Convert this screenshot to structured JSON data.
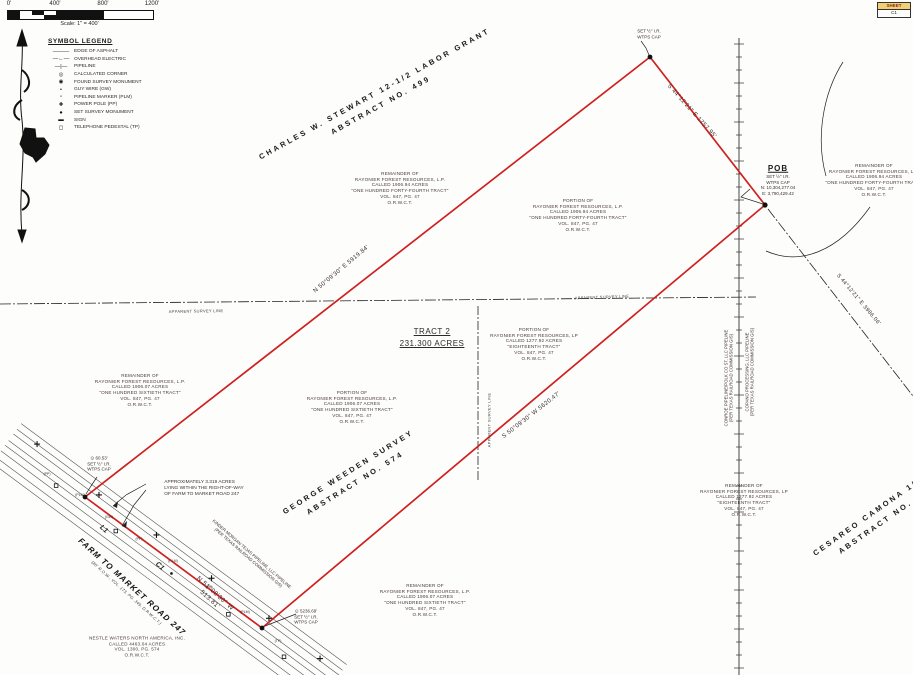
{
  "scalebar": {
    "t0": "0'",
    "t400": "400'",
    "t800": "800'",
    "t1200": "1200'",
    "caption": "Scale: 1\" = 400'"
  },
  "sheetbox": {
    "top": "SHEET",
    "bottom": "C1"
  },
  "legend": {
    "title": "SYMBOL LEGEND",
    "items": [
      {
        "symbol": "———",
        "label": "EDGE OF ASPHALT"
      },
      {
        "symbol": "—←—",
        "label": "OVERHEAD ELECTRIC"
      },
      {
        "symbol": "—|—",
        "label": "PIPELINE"
      },
      {
        "symbol": "◎",
        "label": "CALCULATED CORNER"
      },
      {
        "symbol": "◉",
        "label": "FOUND SURVEY MONUMENT"
      },
      {
        "symbol": "•",
        "label": "GUY WIRE (GW)"
      },
      {
        "symbol": "▫",
        "label": "PIPELINE MARKER (PLM)"
      },
      {
        "symbol": "✚",
        "label": "POWER POLE (PP)"
      },
      {
        "symbol": "●",
        "label": "SET SURVEY MONUMENT"
      },
      {
        "symbol": "▬",
        "label": "SIGN"
      },
      {
        "symbol": "◻",
        "label": "TELEPHONE PEDESTAL (TP)"
      }
    ]
  },
  "surveys": {
    "stewart": [
      "CHARLES W. STEWART 12-1/2 LABOR GRANT",
      "ABSTRACT NO. 499"
    ],
    "weeden": [
      "GEORGE WEEDEN SURVEY",
      "ABSTRACT NO. 574"
    ],
    "camona": [
      "CESAREO CAMONA 1/3",
      "ABSTRACT NO."
    ]
  },
  "tract": {
    "name": "TRACT 2",
    "acres": "231.300 ACRES"
  },
  "bearings": {
    "ne_line": "S 44°12'21\" E  1757.95'",
    "nw_line": "N 50°09'30\" E  5919.84'",
    "se_line": "S 50°09'30\" W  5620.47'",
    "road": [
      "N 51°08'30\" W",
      "513.81'"
    ],
    "right_diag": "S 44°12'21\" E  3986.06'"
  },
  "pob": {
    "title": "POB",
    "lines": [
      "SET ½\" I.R.",
      "WTPS CAP",
      "N: 10,304,277.04",
      "E: 3,790,429.42"
    ]
  },
  "corners": {
    "north": [
      "SET ½\" I.R.",
      "WTPS CAP"
    ],
    "west": [
      "⊙ 60.53'",
      "SET ½\" I.R.",
      "WTPS CAP"
    ],
    "south": [
      "⊙ 5236.69'",
      "SET ½\" I.R.",
      "WTPS CAP"
    ]
  },
  "parcels": [
    {
      "lines": [
        "REMAINDER OF",
        "RAYONIER FOREST RESOURCES, L.P.",
        "CALLED 1906.94 ACRES",
        "\"ONE HUNDRED FORTY-FOURTH TRACT\"",
        "VOL. 847, PG. 47",
        "O.R.W.C.T."
      ]
    },
    {
      "lines": [
        "PORTION OF",
        "RAYONIER FOREST RESOURCES, L.P.",
        "CALLED 1906.94 ACRES",
        "\"ONE HUNDRED FORTY-FOURTH TRACT\"",
        "VOL. 847, PG. 47",
        "O.R.W.C.T."
      ]
    },
    {
      "lines": [
        "REMAINDER OF",
        "RAYONIER FOREST RESOURCES, L.P.",
        "CALLED 1906.94 ACRES",
        "\"ONE HUNDRED FORTY-FOURTH TRACT\"",
        "VOL. 847, PG. 47",
        "O.R.W.C.T."
      ]
    },
    {
      "lines": [
        "PORTION OF",
        "RAYONIER FOREST RESOURCES, LP",
        "CALLED 1277.92 ACRES",
        "\"EIGHTEENTH TRACT\"",
        "VOL. 847, PG. 47",
        "O.R.W.C.T."
      ]
    },
    {
      "lines": [
        "REMAINDER OF",
        "RAYONIER FOREST RESOURCES, L.P.",
        "CALLED 1906.07 ACRES",
        "\"ONE HUNDRED SIXTIETH TRACT\"",
        "VOL. 847, PG. 47",
        "O.R.W.C.T."
      ]
    },
    {
      "lines": [
        "PORTION OF",
        "RAYONIER FOREST RESOURCES, L.P.",
        "CALLED 1906.07 ACRES",
        "\"ONE HUNDRED SIXTIETH TRACT\"",
        "VOL. 847, PG. 47",
        "O.R.W.C.T."
      ]
    },
    {
      "lines": [
        "REMAINDER OF",
        "RAYONIER FOREST RESOURCES, L.P.",
        "CALLED 1906.07 ACRES",
        "\"ONE HUNDRED SIXTIETH TRACT\"",
        "VOL. 847, PG. 47",
        "O.R.W.C.T."
      ]
    },
    {
      "lines": [
        "REMAINDER OF",
        "RAYONIER FOREST RESOURCES, LP",
        "CALLED 1277.92 ACRES",
        "\"EIGHTEENTH TRACT\"",
        "VOL. 847, PG. 47",
        "O.R.W.C.T."
      ]
    }
  ],
  "nestle": {
    "lines": [
      "NESTLE WATERS NORTH AMERICA, INC.",
      "CALLED 4463.04 ACRES",
      "VOL. 1300, PG. 574",
      "O.R.W.C.T."
    ]
  },
  "road": {
    "name": "FARM TO MARKET ROAD 247",
    "row": "(80' R.O.W., VOL. 173, PG. 349, D.R.W.C.T.)",
    "l1": "L1",
    "c1": "C1"
  },
  "notes": {
    "acres3319": [
      "APPROXIMATELY 3.319 ACRES",
      "LYING WITHIN THE RIGHT-OF-WAY",
      "OF FARM TO MARKET ROAD 247"
    ]
  },
  "pipelines": {
    "kinder": [
      "KINDER MORGAN TEJAS PIPELINE, LLC PIPELINE",
      "(PER TEXAS RAILROAD COMMISSION GIS)"
    ],
    "vertical1": [
      "COPANO PROCESSING, LLC PIPELINE",
      "(PER TEXAS RAILROAD COMMISSION GIS)"
    ],
    "vertical2": [
      "CONROE PIPELINE/POLK CO ST, LLC PIPELINE",
      "(PER TEXAS RAILROAD COMMISSION GIS)"
    ]
  },
  "apparent_line_label": "APPARENT SURVEY LINE",
  "marker_labels": {
    "pp": "(PP)",
    "plm": "(PLM)",
    "gw": "(GW)",
    "tp": "(TP)"
  },
  "colors": {
    "boundary_red": "#cf2020",
    "ink": "#1a1a1a"
  }
}
